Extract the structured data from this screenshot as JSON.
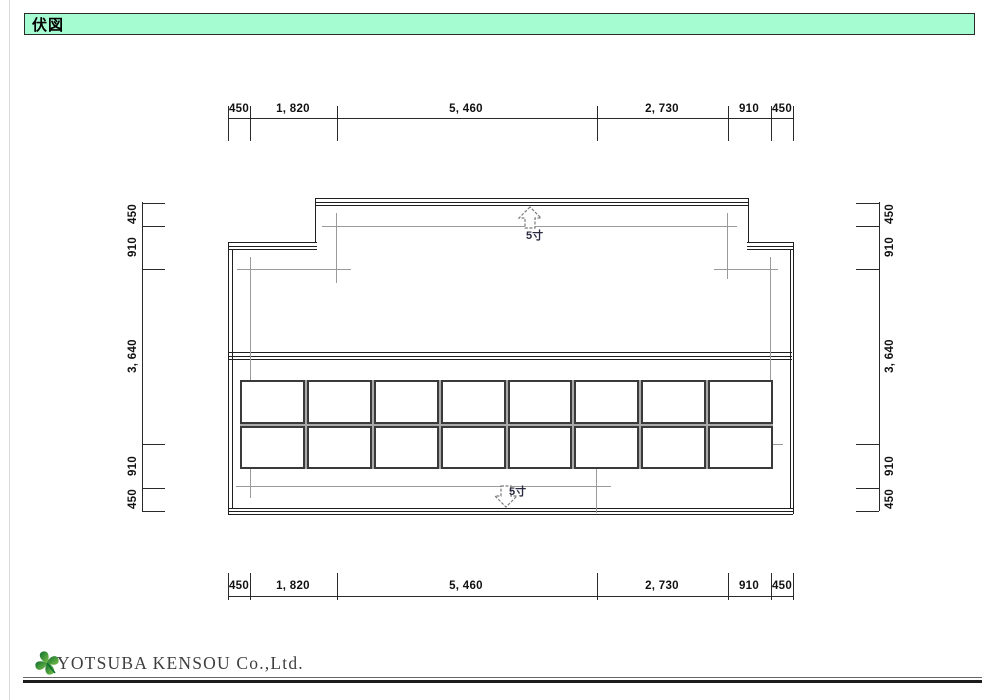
{
  "title_bar": {
    "title": "伏図"
  },
  "plan": {
    "dimensions": {
      "top": [
        "450",
        "1, 820",
        "5, 460",
        "2, 730",
        "910",
        "450"
      ],
      "bottom": [
        "450",
        "1, 820",
        "5, 460",
        "2, 730",
        "910",
        "450"
      ],
      "left": [
        "450",
        "910",
        "3, 640",
        "910",
        "450"
      ],
      "right": [
        "450",
        "910",
        "3, 640",
        "910",
        "450"
      ]
    },
    "slope_arrow_up": {
      "label": "5寸"
    },
    "slope_arrow_down": {
      "label": "5寸"
    },
    "panel_grid": {
      "rows": 2,
      "columns": 8
    }
  },
  "footer": {
    "company_name": "YOTSUBA KENSOU Co.,Ltd."
  },
  "colors": {
    "title_bar_bg": "#a5fcd1",
    "line_dark": "#1f1f1f",
    "line_gray": "#9a9a9a",
    "slope_text": "#2a2a40",
    "logo_green_dark": "#0e6f2e",
    "logo_green_light": "#7cc24a"
  }
}
